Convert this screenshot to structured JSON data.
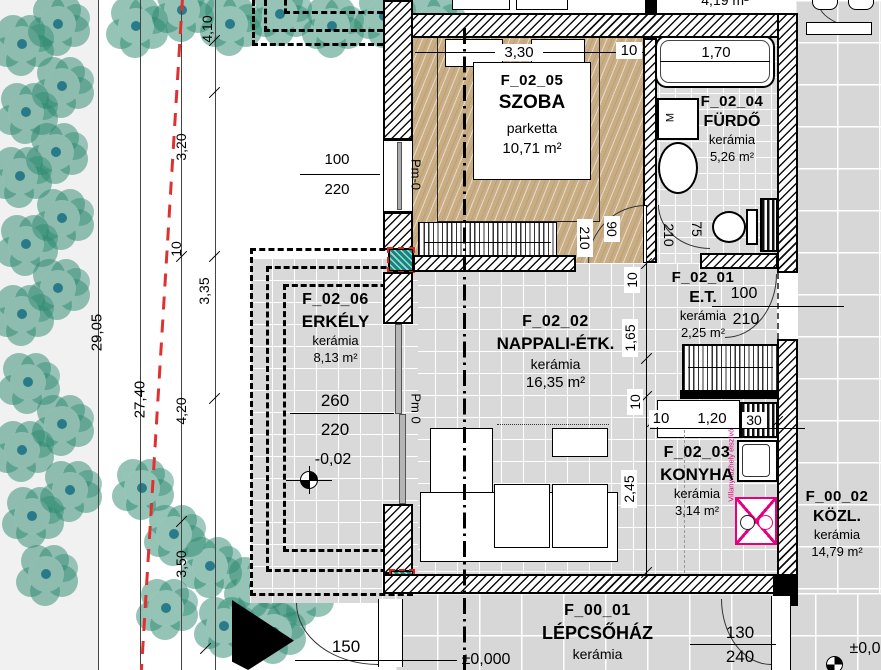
{
  "plan": {
    "rooms": {
      "szoba": {
        "code": "F_02_05",
        "name": "SZOBA",
        "material": "parketta",
        "area": "10,71 m²"
      },
      "furdo": {
        "code": "F_02_04",
        "name": "FÜRDŐ",
        "material": "kerámia",
        "area": "5,26 m²"
      },
      "et": {
        "code": "F_02_01",
        "name": "E.T.",
        "material": "kerámia",
        "area": "2,25 m²"
      },
      "nappali": {
        "code": "F_02_02",
        "name": "NAPPALI-ÉTK.",
        "material": "kerámia",
        "area": "16,35 m²"
      },
      "konyha": {
        "code": "F_02_03",
        "name": "KONYHA",
        "material": "kerámia",
        "area": "3,14 m²"
      },
      "erkely": {
        "code": "F_02_06",
        "name": "ERKÉLY",
        "material": "kerámia",
        "area": "8,13 m²"
      },
      "kozl": {
        "code": "F_00_02",
        "name": "KÖZL.",
        "material": "kerámia",
        "area": "14,79 m²"
      },
      "lepcsohaz": {
        "code": "F_00_01",
        "name": "LÉPCSŐHÁZ",
        "material": "kerámia"
      },
      "neighbor_area_partial": "4,19 m²"
    },
    "dims": {
      "site": {
        "s1": "4,10",
        "s2": "3,20",
        "s3": "10",
        "s4": "3,35",
        "s5": "29,05",
        "s6": "27,40",
        "s7": "4,20",
        "s8": "3,50"
      },
      "szoba": {
        "width": "3,30",
        "wall": "10",
        "window_w": "100",
        "window_h": "220",
        "door_w": "90",
        "door_h": "210",
        "parapet": "Pm-0"
      },
      "furdo": {
        "tub": "1,70",
        "door_h": "210",
        "door_w": "75"
      },
      "et": {
        "door_w": "100",
        "door_h": "210"
      },
      "chain": {
        "c1": "10",
        "c2": "1,65",
        "c3": "10",
        "c4": "2,45"
      },
      "konyha": {
        "k1": "10",
        "k2": "1,20",
        "k3": "30"
      },
      "erkely": {
        "door_w": "260",
        "door_h": "220",
        "level": "-0,02",
        "parapet": "Pm 0"
      },
      "lepcsohaz": {
        "door_w": "130",
        "door_h": "240",
        "entry": "150",
        "level": "±0,000",
        "level_right": "±0,0"
      }
    },
    "annotations": {
      "stove": "Villany tűzhely elszívó",
      "washer": "M"
    }
  }
}
